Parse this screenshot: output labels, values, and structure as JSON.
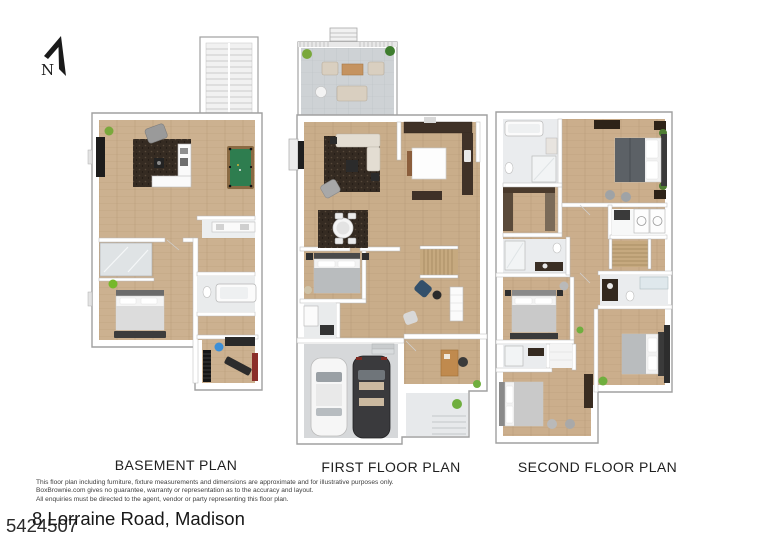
{
  "compass": {
    "label": "N",
    "icon": "north-arrow-icon"
  },
  "plans": [
    {
      "id": "basement",
      "label": "BASEMENT PLAN"
    },
    {
      "id": "first",
      "label": "FIRST FLOOR PLAN"
    },
    {
      "id": "second",
      "label": "SECOND FLOOR PLAN"
    }
  ],
  "footer": {
    "disclaimer_lines": [
      "This floor plan including furniture, fixture measurements and dimensions are approximate and for illustrative purposes only.",
      "BoxBrownie.com gives no guarantee, warranty or representation as to the accuracy and layout.",
      "All enquiries must be directed to the agent, vendor or party representing this floor plan."
    ],
    "address": "8 Lorraine Road, Madison",
    "listing_number": "5424507"
  },
  "colors": {
    "background": "#ffffff",
    "wall": "#ffffff",
    "wall_edge": "#a0a0a0",
    "wood_floor": "#ccb190",
    "deck_paver": "#ced2d5",
    "tile": "#eaecee",
    "pool_table_felt": "#2e7d4f",
    "dark_rug": "#352b22",
    "kitchen_cabinet_dark": "#3f3127",
    "car_white": "#f6f6f6",
    "car_dark": "#3a3a3d",
    "plant_green": "#6fae3e",
    "garage_floor": "#d6d8da",
    "text_black": "#1f1f1f"
  }
}
